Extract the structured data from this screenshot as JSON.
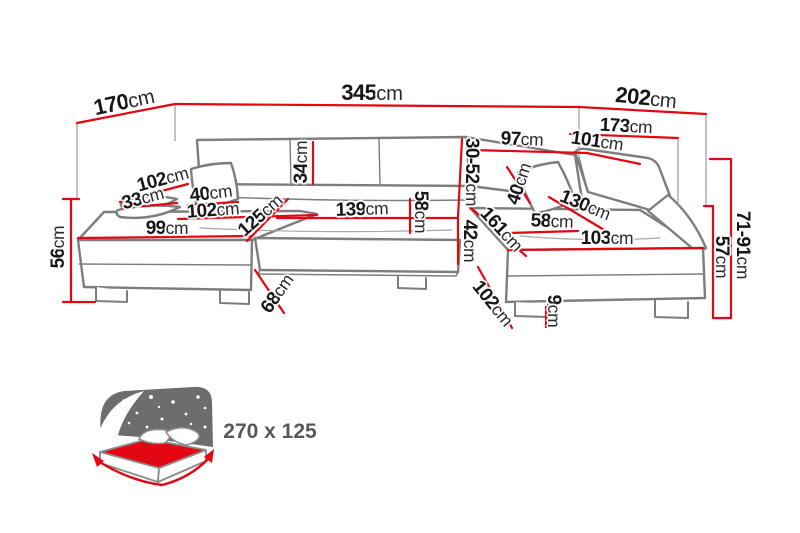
{
  "diagram": {
    "title": "corner-sofa-dimension-diagram",
    "colors": {
      "dimension_line": "#e30613",
      "sofa_outline": "#7d7d7d",
      "label_text": "#161616",
      "bed_text": "#58585a",
      "mattress_red": "#e30613",
      "headboard_gray": "#6d6d6d"
    },
    "dimensions": [
      {
        "id": "total-depth-left",
        "value": "170",
        "unit": "cm"
      },
      {
        "id": "total-width",
        "value": "345",
        "unit": "cm"
      },
      {
        "id": "total-depth-right",
        "value": "202",
        "unit": "cm"
      },
      {
        "id": "right-side-width",
        "value": "173",
        "unit": "cm"
      },
      {
        "id": "back-right-width",
        "value": "97",
        "unit": "cm"
      },
      {
        "id": "right-backrest-width",
        "value": "101",
        "unit": "cm"
      },
      {
        "id": "backrest-height",
        "value": "34",
        "unit": "cm"
      },
      {
        "id": "headrest-height-range",
        "value": "30-52",
        "unit": "cm"
      },
      {
        "id": "left-armrest-depth",
        "value": "102",
        "unit": "cm"
      },
      {
        "id": "left-arm-pillow-width",
        "value": "33",
        "unit": "cm"
      },
      {
        "id": "left-pillow-width",
        "value": "40",
        "unit": "cm"
      },
      {
        "id": "left-seat-width",
        "value": "102",
        "unit": "cm"
      },
      {
        "id": "left-chaise-seat-depth",
        "value": "125",
        "unit": "cm"
      },
      {
        "id": "left-chaise-front-width",
        "value": "99",
        "unit": "cm"
      },
      {
        "id": "center-seat-width",
        "value": "139",
        "unit": "cm"
      },
      {
        "id": "seat-depth",
        "value": "58",
        "unit": "cm"
      },
      {
        "id": "seat-front-height",
        "value": "42",
        "unit": "cm"
      },
      {
        "id": "right-chaise-depth",
        "value": "161",
        "unit": "cm"
      },
      {
        "id": "right-seat-width",
        "value": "58",
        "unit": "cm"
      },
      {
        "id": "right-pillow-width",
        "value": "40",
        "unit": "cm"
      },
      {
        "id": "right-backrest-length",
        "value": "130",
        "unit": "cm"
      },
      {
        "id": "right-chaise-front-width",
        "value": "103",
        "unit": "cm"
      },
      {
        "id": "right-chaise-side-depth",
        "value": "102",
        "unit": "cm"
      },
      {
        "id": "foot-height",
        "value": "9",
        "unit": "cm"
      },
      {
        "id": "corner-front-depth",
        "value": "68",
        "unit": "cm"
      },
      {
        "id": "left-side-height",
        "value": "56",
        "unit": "cm"
      },
      {
        "id": "right-seat-height",
        "value": "57",
        "unit": "cm"
      },
      {
        "id": "right-backrest-height-range",
        "value": "71-91",
        "unit": "cm"
      }
    ],
    "bed": {
      "size_label": "270 x 125"
    }
  }
}
